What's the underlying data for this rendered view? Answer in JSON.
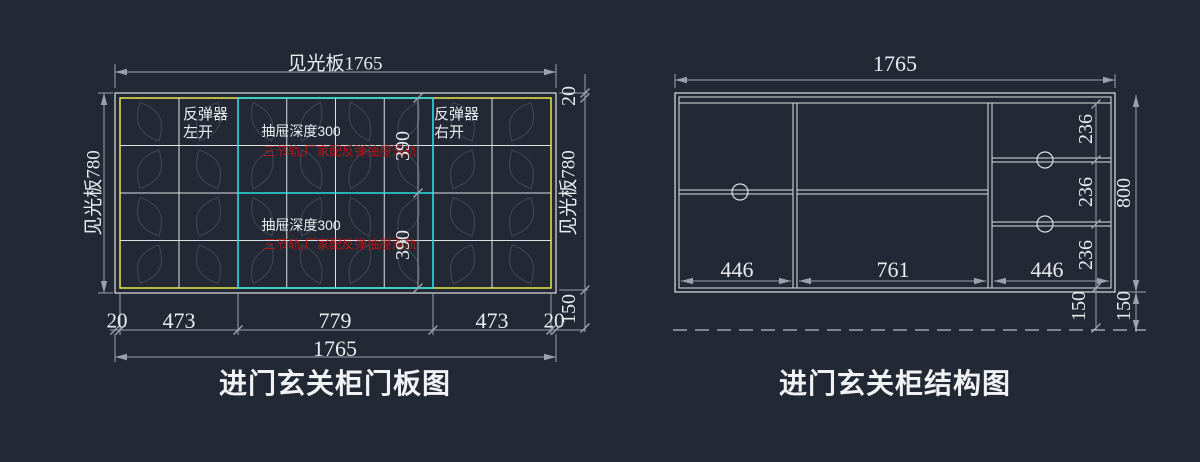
{
  "left": {
    "title": "进门玄关柜门板图",
    "top_dim": "见光板1765",
    "side_dim": "见光板780",
    "right_chain": [
      "20",
      "见光板780",
      "150"
    ],
    "bottom_chain": [
      "20",
      "473",
      "779",
      "473",
      "20"
    ],
    "total": "1765",
    "rebound_left_1": "反弹器",
    "rebound_left_2": "左开",
    "rebound_right_1": "反弹器",
    "rebound_right_2": "右开",
    "drawer_depth": "抽屉深度300",
    "drawer_note": "三节轨,厂家配反弹抽屉滑轨",
    "drawer_height": "390"
  },
  "right": {
    "title": "进门玄关柜结构图",
    "top_dim": "1765",
    "col_dims": [
      "446",
      "761",
      "446"
    ],
    "shelf_dims": [
      "236",
      "236",
      "236"
    ],
    "inner_floor": "150",
    "height": "800",
    "floor_gap": "150"
  },
  "colors": {
    "background": "#222834",
    "line": "#dde1e6",
    "dim_line": "#9aa1ad",
    "dim_text": "#e9ecef",
    "frame_yellow": "#e8e84f",
    "drawer_cyan": "#2ae0e0",
    "note_red": "#b31616",
    "leaf": "#3f4654"
  }
}
